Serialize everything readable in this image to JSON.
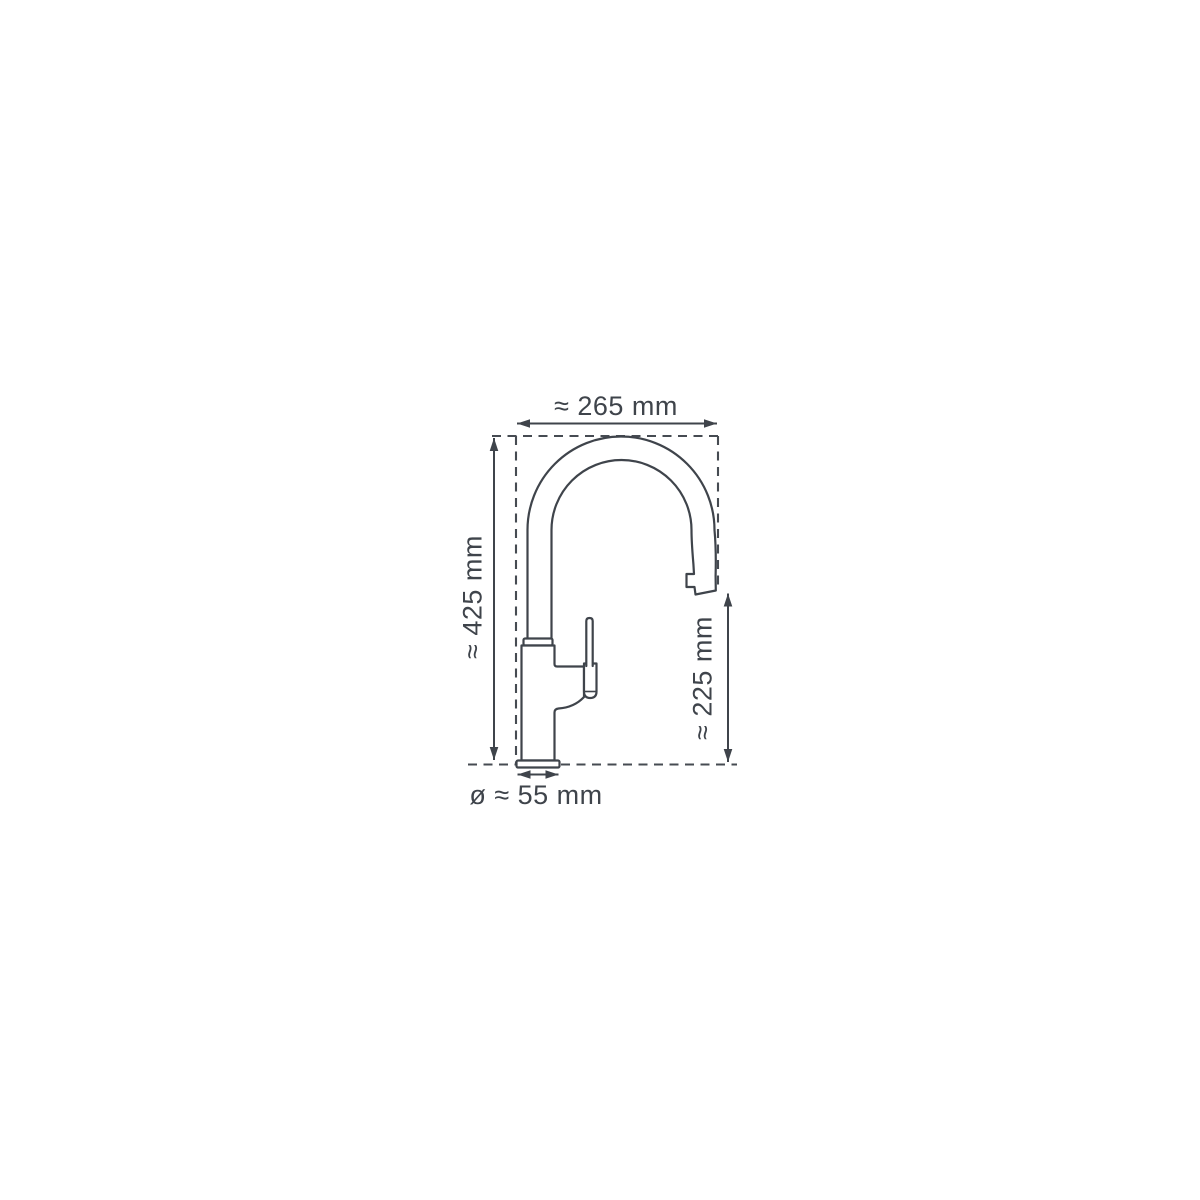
{
  "page": {
    "background_color": "#ffffff"
  },
  "diagram": {
    "type": "technical-dimension-drawing",
    "subject": "kitchen faucet with high-arc spout and pull-out spray head, side view",
    "line_color": "#3f444b",
    "fill_color": "#ffffff",
    "dimensions": {
      "spout_width": {
        "label": "≈ 265 mm",
        "position": "top",
        "orientation": "horizontal"
      },
      "total_height": {
        "label": "≈ 425 mm",
        "position": "left",
        "orientation": "vertical"
      },
      "outlet_height": {
        "label": "≈ 225 mm",
        "position": "right",
        "orientation": "vertical"
      },
      "base_diameter": {
        "label": "ø ≈ 55 mm",
        "position": "bottom",
        "orientation": "horizontal"
      }
    }
  }
}
